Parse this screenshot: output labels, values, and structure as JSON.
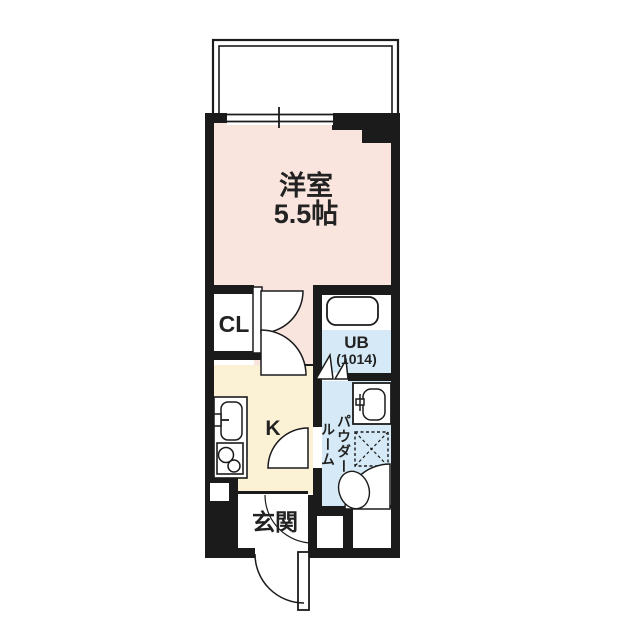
{
  "floorplan": {
    "title": "1K apartment floor plan",
    "colors": {
      "wall": "#1b1b1b",
      "living_room": "#f9e4de",
      "kitchen": "#fbf2d6",
      "water_area": "#d5eaf6",
      "background": "#ffffff"
    },
    "rooms": {
      "living": {
        "name": "洋室",
        "size": "5.5帖"
      },
      "closet": {
        "name": "CL"
      },
      "unit_bath": {
        "name": "UB",
        "size": "(1014)"
      },
      "kitchen": {
        "name": "K"
      },
      "powder": {
        "name": "パウダールーム"
      },
      "entrance": {
        "name": "玄関"
      }
    }
  }
}
